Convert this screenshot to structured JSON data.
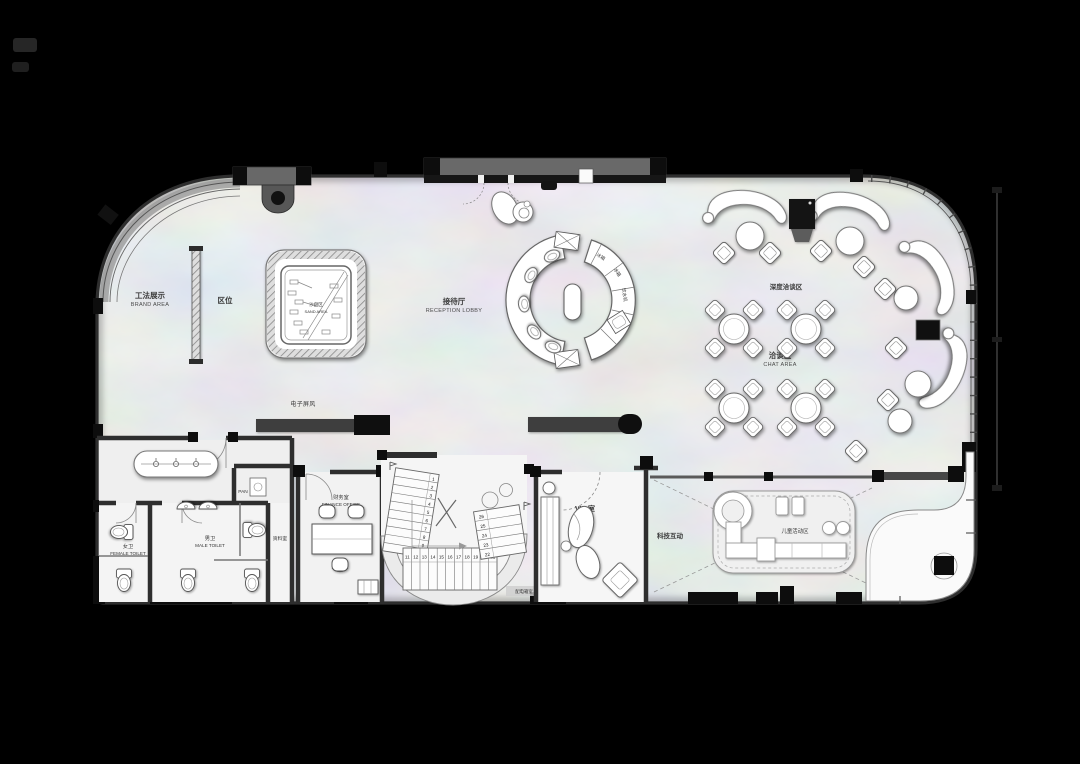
{
  "plan": {
    "areas": {
      "brand": {
        "cn": "工法展示",
        "en": "BRAND AREA"
      },
      "location": {
        "cn": "区位"
      },
      "sand": {
        "cn": "沙盘区",
        "en": "SAND AREA"
      },
      "screen": {
        "cn": "电子屏风"
      },
      "reception": {
        "cn": "接待厅",
        "en": "RECEPTION LOBBY"
      },
      "deep_chat": {
        "cn": "深度洽谈区"
      },
      "chat": {
        "cn": "洽谈区",
        "en": "CHAT AREA"
      },
      "female_toilet": {
        "cn": "女卫",
        "en": "FEMALE TOILET"
      },
      "male_toilet": {
        "cn": "男卫",
        "en": "MALE TOILET"
      },
      "pantry": {
        "cn": "PAN"
      },
      "archive": {
        "cn": "资料室"
      },
      "finance": {
        "cn": "财务室",
        "en": "FINANCE OFFICE"
      },
      "vip": {
        "cn": "VIP 室"
      },
      "tech": {
        "cn": "科技互动"
      },
      "kids": {
        "cn": "儿童活动区"
      },
      "power_room": {
        "cn": "配电箱室"
      }
    },
    "equipment": {
      "fridge_1": "冰箱",
      "fridge_2": "冰箱",
      "water_dispenser": "饮水机"
    },
    "stairs": {
      "flight_a": [
        "1",
        "2",
        "3",
        "4",
        "5",
        "6",
        "7",
        "8",
        "9",
        "10"
      ],
      "flight_b": [
        "11",
        "12",
        "13",
        "14",
        "15",
        "16",
        "17",
        "18",
        "19",
        "20",
        "21"
      ],
      "flight_c": [
        "22",
        "23",
        "24",
        "25",
        "26"
      ]
    },
    "colors": {
      "background": "#000000",
      "floor_marble": "#d7d7d7",
      "wall_dark": "#2e2e2e",
      "canopy_gray": "#666666",
      "furniture_white": "#ffffff",
      "line_gray": "#777777"
    }
  }
}
